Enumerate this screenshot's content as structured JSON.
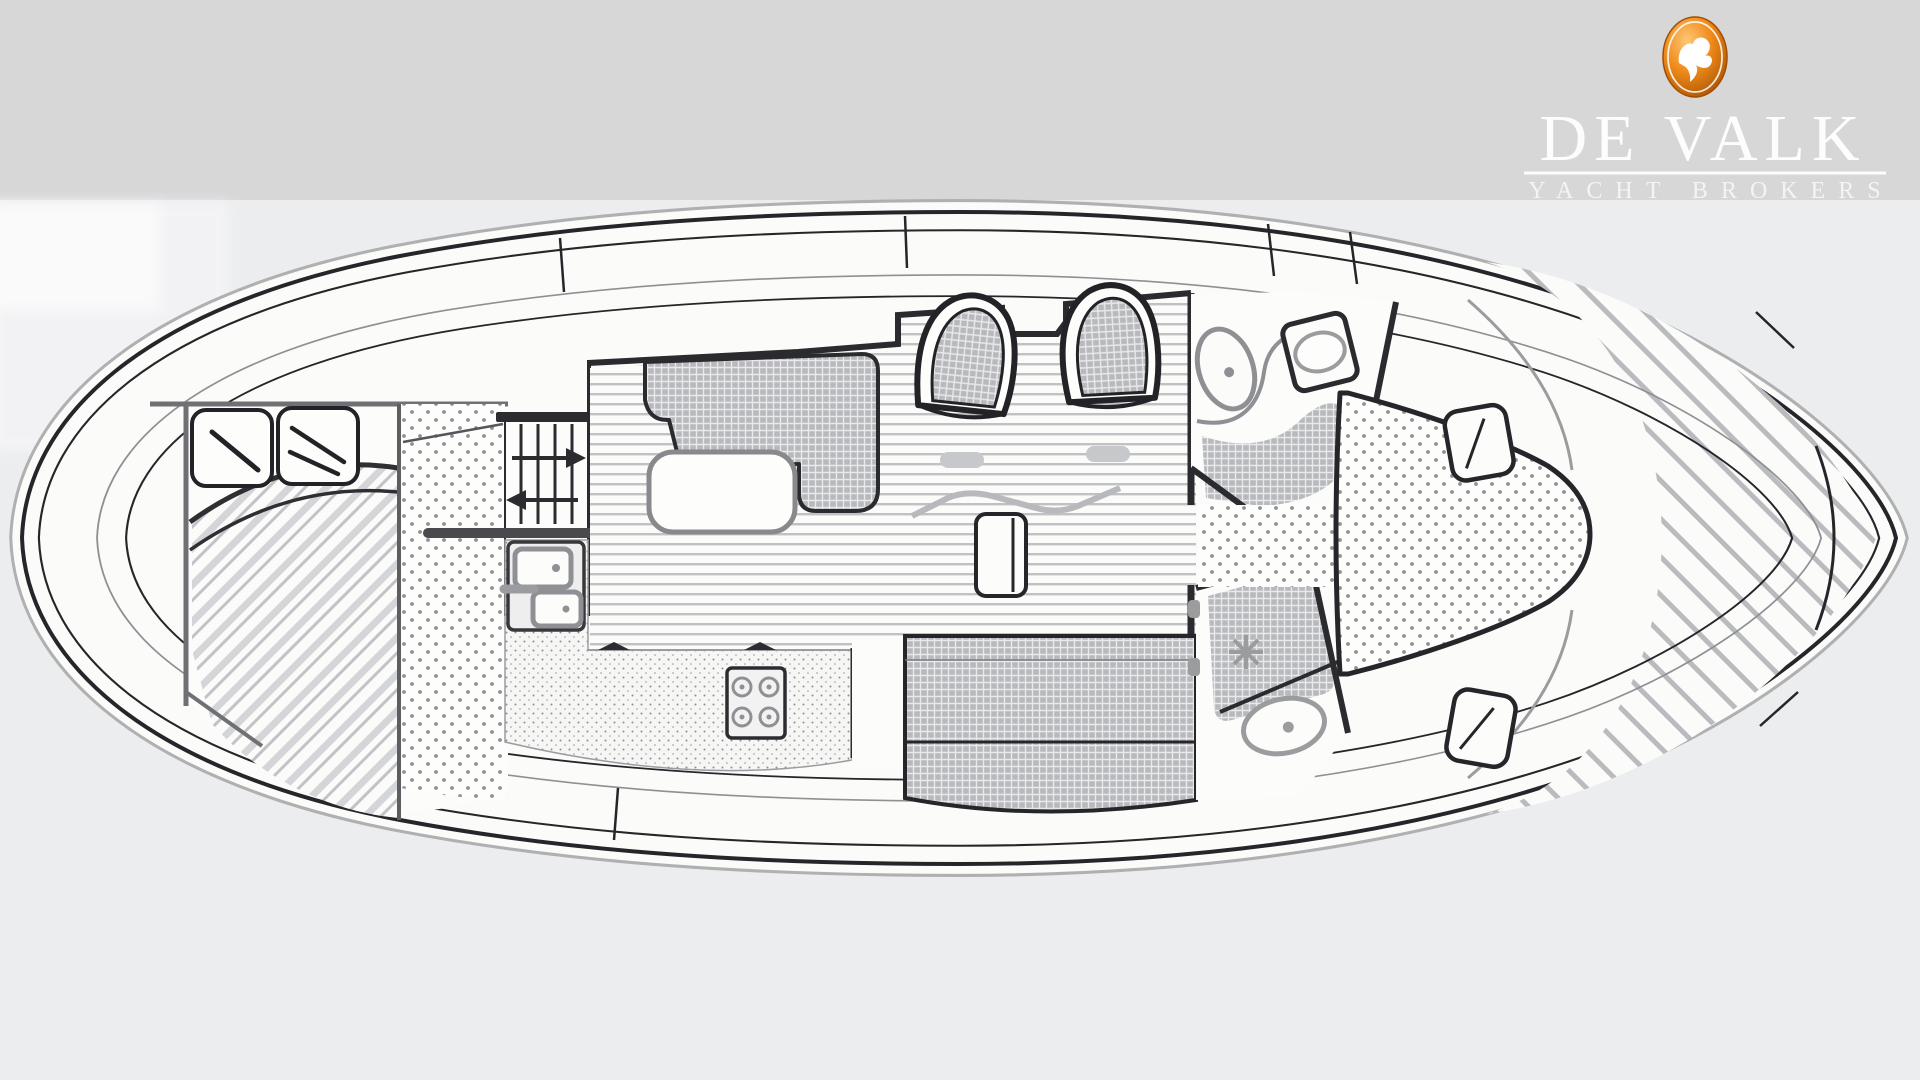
{
  "brand": {
    "name": "DE VALK",
    "tagline": "YACHT BROKERS",
    "logo_icon": "falcon-icon",
    "logo_orange": "#e07c12",
    "logo_orange_dark": "#9c4a00",
    "text_color": "#fdfdfd"
  },
  "page": {
    "top_band_color": "#d7d7d8",
    "scan_background_color": "#ecedee",
    "line_color": "#26262a",
    "wall_gray": "#6f7074",
    "fixture_gray": "#8e9094",
    "pattern_gray": "#c9cacd"
  },
  "floor_plan": {
    "type": "yacht-interior-deck-plan",
    "orientation": "bow-right-stern-left",
    "areas": [
      {
        "id": "aft-deck",
        "label": "aft deck"
      },
      {
        "id": "aft-cabin",
        "label": "aft cabin with double berth and two pillows"
      },
      {
        "id": "wardrobe",
        "label": "wardrobe / locker strip"
      },
      {
        "id": "companionway-stairs",
        "label": "companionway stairs with up and down arrows"
      },
      {
        "id": "galley",
        "label": "galley with double sink, counter and 4-burner stove"
      },
      {
        "id": "dinette",
        "label": "dinette with L-settee and table"
      },
      {
        "id": "helm",
        "label": "helm station with console and two seats"
      },
      {
        "id": "salon-bench",
        "label": "starboard salon bench"
      },
      {
        "id": "head-forward",
        "label": "head with toilet and washbasin"
      },
      {
        "id": "shower-head",
        "label": "shower compartment with drain and toilet"
      },
      {
        "id": "v-berth",
        "label": "forward V-berth"
      },
      {
        "id": "foredeck",
        "label": "hatched foredeck with side hatches"
      }
    ]
  }
}
